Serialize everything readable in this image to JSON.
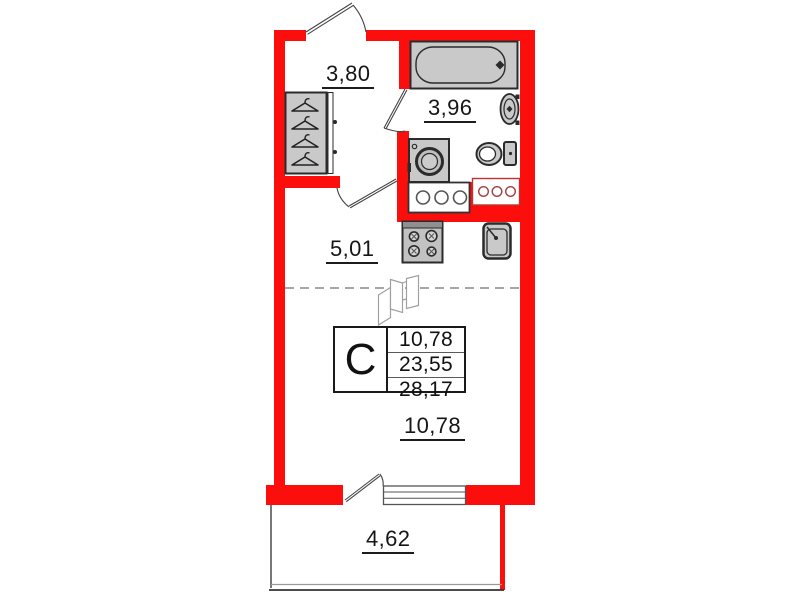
{
  "unit": {
    "type_label": "С",
    "area_rows": [
      "10,78",
      "23,55",
      "28,17"
    ]
  },
  "rooms": {
    "hallway": {
      "area": "3,80"
    },
    "bathroom": {
      "area": "3,96"
    },
    "kitchen_zone": {
      "area": "5,01"
    },
    "living_zone": {
      "area": "10,78"
    },
    "balcony": {
      "area": "4,62"
    }
  },
  "fixtures": [
    "bathtub-icon",
    "washbasin-icon",
    "toilet-icon",
    "washing-machine-icon",
    "stove-icon",
    "kitchen-sink-icon",
    "wardrobe-icon",
    "hanger-icon",
    "folding-screen-icon",
    "vent-shaft-icon",
    "door-swing-icon",
    "window-icon"
  ],
  "colors": {
    "wall": "#fb0e0c",
    "fixture_fill": "#c9c9c9",
    "outline": "#2b2b2b",
    "label_text": "#161616"
  }
}
